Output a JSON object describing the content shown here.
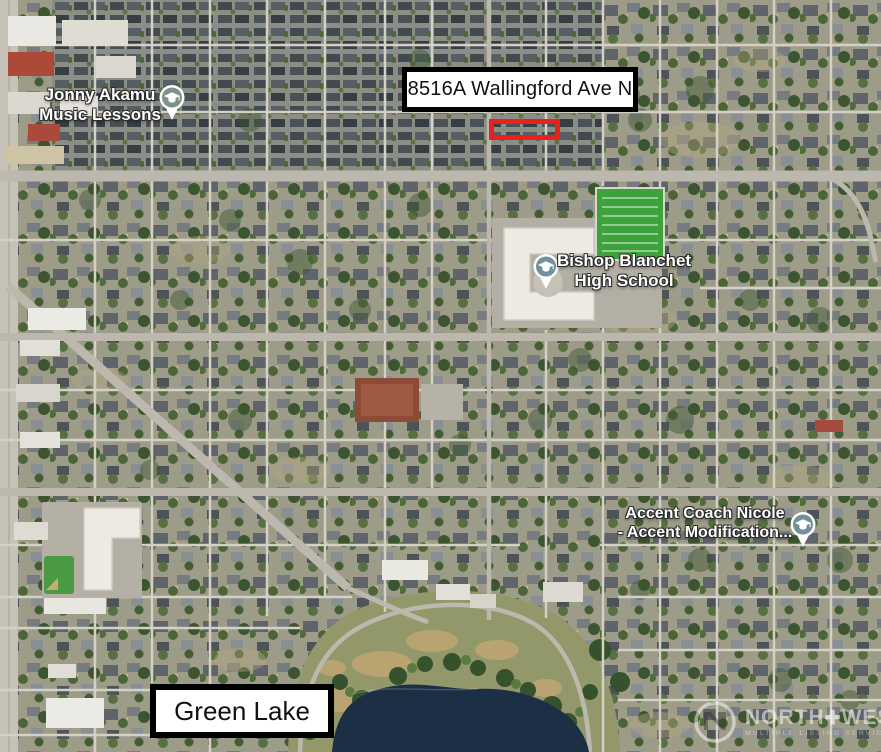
{
  "map_overlays": {
    "address_callout": "8516A Wallingford Ave N",
    "lake_callout": "Green Lake"
  },
  "pois": [
    {
      "line1": "Jonny Akamu",
      "line2": "Music Lessons",
      "icon": "graduation-cap",
      "pin_color": "#7e938b"
    },
    {
      "line1": "Bishop Blanchet",
      "line2": "High School",
      "icon": "graduation-cap",
      "pin_color": "#73909d"
    },
    {
      "line1": "Accent Coach Nicole",
      "line2": "- Accent Modification...",
      "icon": "graduation-cap",
      "pin_color": "#73909d"
    }
  ],
  "highlight": {
    "color": "#e8211d"
  },
  "watermark": {
    "brand_left": "NORTH",
    "divider": "✚",
    "brand_right": "WEST",
    "tagline": "MULTIPLE LISTING SERVICE"
  },
  "palette": {
    "water": "#1c2f45",
    "field_green": "#3da23c",
    "street": "#d4d0c6",
    "major_street": "#bcb8ae",
    "park": "#93986b"
  }
}
